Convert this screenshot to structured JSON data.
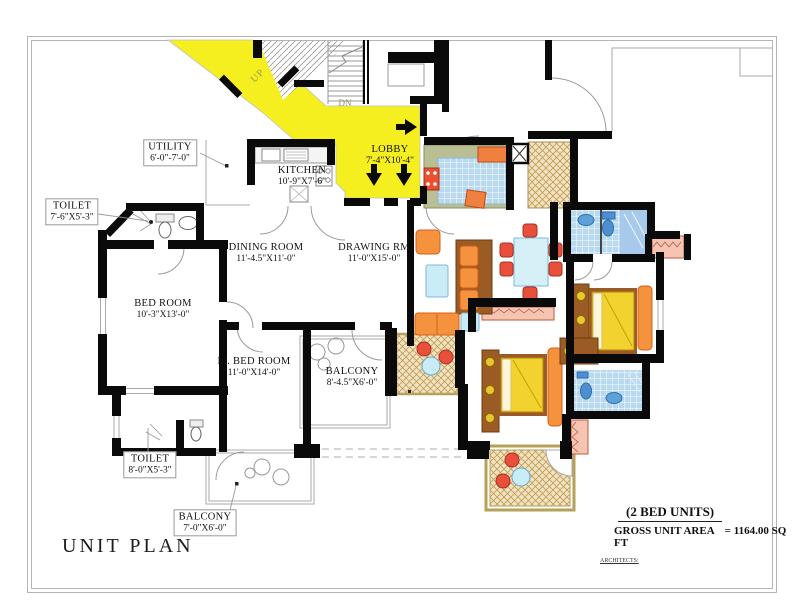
{
  "title": "UNIT PLAN",
  "summary": {
    "units_type": "(2 BED UNITS)",
    "gross_label": "GROSS UNIT AREA",
    "gross_value": "= 1164.00  SQ FT",
    "architects": "ARCHITECTS:"
  },
  "stairs": {
    "up": "UP",
    "dn": "DN"
  },
  "rooms": {
    "utility": {
      "name": "UTILITY",
      "dims": "6'-0\"-7'-0\""
    },
    "toilet_top": {
      "name": "TOILET",
      "dims": "7'-6\"X5'-3\""
    },
    "kitchen": {
      "name": "KITCHEN",
      "dims": "10'-9\"X7'-6\""
    },
    "lobby": {
      "name": "LOBBY",
      "dims": "7'-4\"X10'-4\""
    },
    "dining": {
      "name": "DINING ROOM",
      "dims": "11'-4.5\"X11'-0\""
    },
    "drawing": {
      "name": "DRAWING RM",
      "dims": "11'-0\"X15'-0\""
    },
    "bedroom": {
      "name": "BED ROOM",
      "dims": "10'-3\"X13'-0\""
    },
    "master_bedroom": {
      "name": "M. BED ROOM",
      "dims": "11'-0\"X14'-0\""
    },
    "balcony_mid": {
      "name": "BALCONY",
      "dims": "8'-4.5\"X6'-0\""
    },
    "toilet_bottom": {
      "name": "TOILET",
      "dims": "8'-0\"X5'-3\""
    },
    "balcony_bottom": {
      "name": "BALCONY",
      "dims": "7'-0\"X6'-0\""
    }
  },
  "colors": {
    "corridor": "#f6ef1f",
    "wall": "#0a0a0a",
    "hatch_tan": "#e9d4a2",
    "tile_blue": "#b8d9ee",
    "kitchen_green": "#b9bf93",
    "furniture_orange": "#f5923e",
    "chair_red": "#e8503c",
    "table_blue": "#c9ecf6",
    "bed_yellow": "#f2d22e",
    "wood_brown": "#9a5b24",
    "planter_pink": "#f6c5b2"
  }
}
